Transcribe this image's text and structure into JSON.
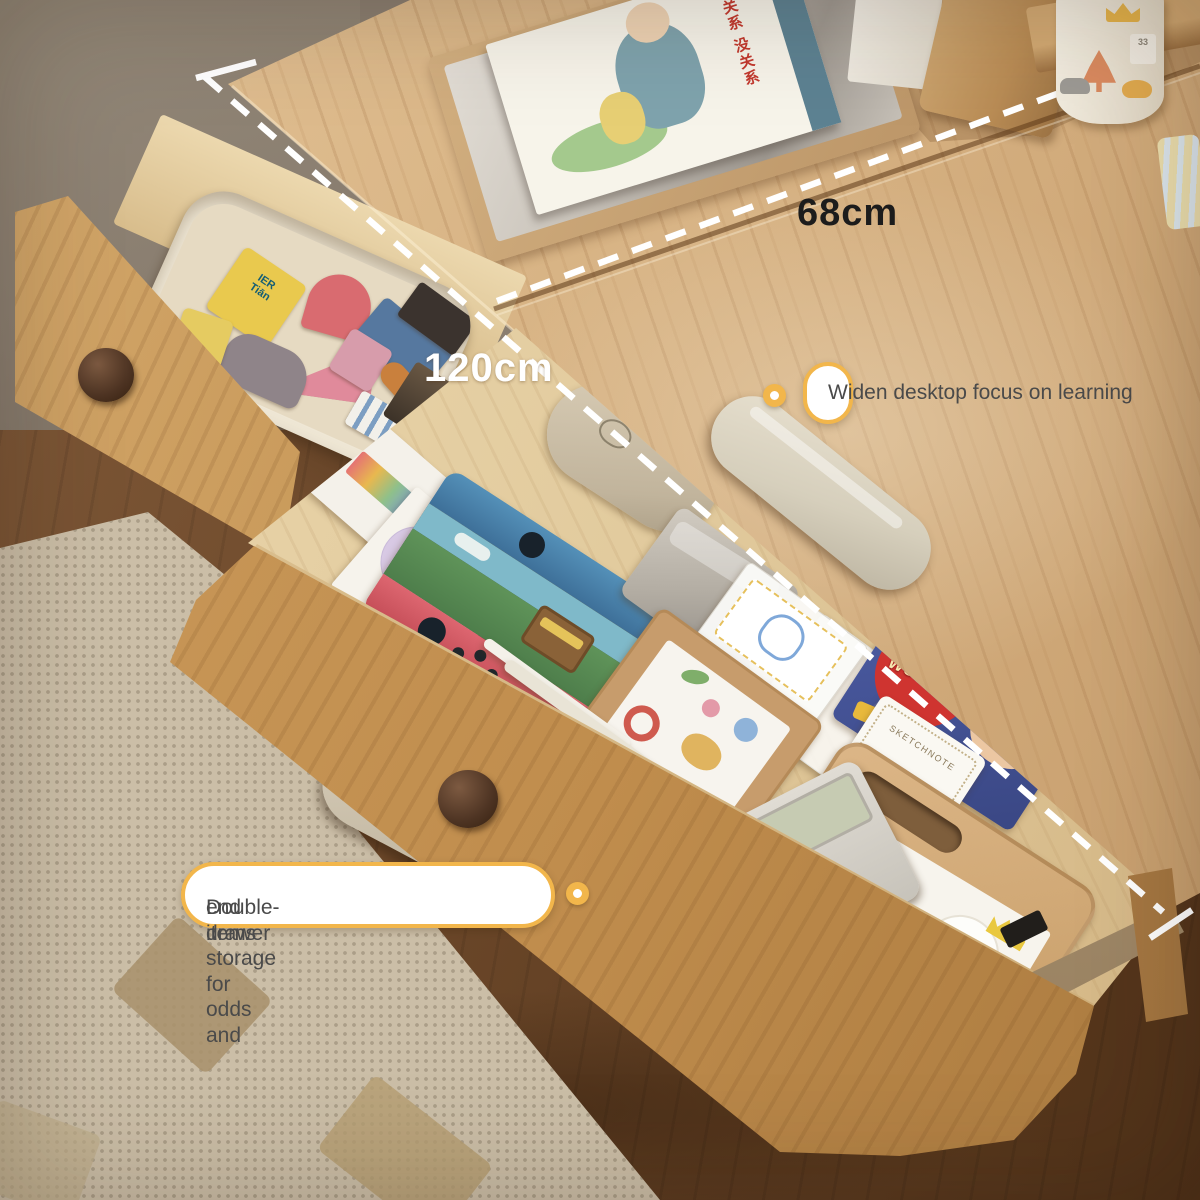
{
  "annotations": {
    "depth_label": "68cm",
    "width_label": "120cm",
    "callout_desktop": "Widen desktop focus on learning",
    "callout_drawer_line1": "Double-drawer storage for odds and",
    "callout_drawer_line2": "end items"
  },
  "items": {
    "book_title": "没关系 没关系",
    "washi_box_logo": "WALT",
    "card_box_label": "Water",
    "wonder_box_label": "WONDER",
    "photo_frame_title": "IT'S A BOY!",
    "photo_frame_subtitle": "PHOTO FRAME",
    "sketch_tag_label": "SKETCHNOTE",
    "toy_block_line1": "IER",
    "toy_block_line2": "Tiān",
    "pen_cup_house_label": "33"
  },
  "colors": {
    "accent_yellow": "#F2B64B",
    "dashed_line": "#FFFFFF",
    "depth_text": "#1C1C1C",
    "width_text": "#FFFFFF",
    "callout_text": "#4A4A4A",
    "desk_wood": "#D9B586",
    "drawer_wood": "#C3914F",
    "floor_wood": "#6B4729",
    "carpet": "#CBBEA7"
  }
}
